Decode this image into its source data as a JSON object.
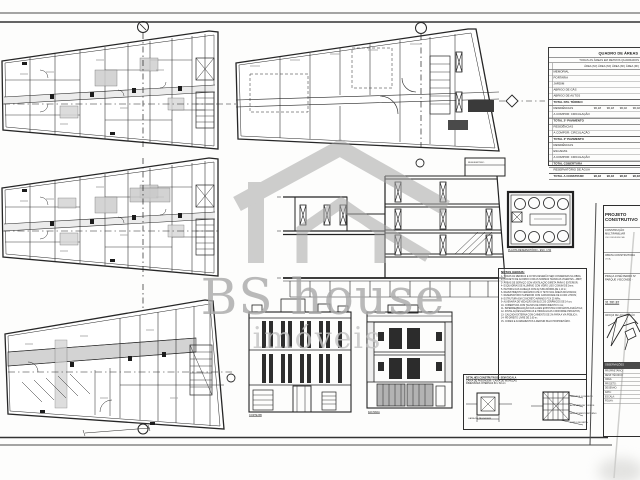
{
  "watermark": {
    "title": "BS house",
    "subtitle": "imóveis"
  },
  "area_table": {
    "title": "QUADRO DE ÁREAS",
    "subtitle": "TODAS AS ÁREAS EM METROS QUADRADOS",
    "col_header": "ÁREA (M²)    ÁREA (M²)    ÁREA (M²)    ÁREA (M²)",
    "rows": [
      {
        "label": "MEMORIAL",
        "vals": [
          "",
          "",
          "",
          ""
        ],
        "total": false
      },
      {
        "label": "PORTARIA",
        "vals": [
          "",
          "",
          "",
          ""
        ],
        "total": false
      },
      {
        "label": "JARDIM",
        "vals": [
          "",
          "",
          "",
          ""
        ],
        "total": false
      },
      {
        "label": "ABRIGO DE GÁS",
        "vals": [
          "",
          "",
          "",
          ""
        ],
        "total": false
      },
      {
        "label": "ABRIGO DE AUTOS",
        "vals": [
          "",
          "",
          "",
          ""
        ],
        "total": false
      },
      {
        "label": "TOTAL PAV. TÉRREO",
        "vals": [
          "",
          "",
          "",
          ""
        ],
        "total": true
      },
      {
        "label": "RESIDÊNCIAS",
        "vals": [
          "96,18",
          "96,18",
          "96,02",
          "96,02"
        ],
        "total": false
      },
      {
        "label": "A COMPOR: CIRCULAÇÃO",
        "vals": [
          "",
          "",
          "",
          ""
        ],
        "total": false
      },
      {
        "label": "TOTAL 2º PAVIMENTO",
        "vals": [
          "",
          "",
          "",
          ""
        ],
        "total": true
      },
      {
        "label": "RESIDÊNCIAS",
        "vals": [
          "",
          "",
          "",
          ""
        ],
        "total": false
      },
      {
        "label": "A COMPOR: CIRCULAÇÃO",
        "vals": [
          "",
          "",
          "",
          ""
        ],
        "total": false
      },
      {
        "label": "TOTAL 3º PAVIMENTO",
        "vals": [
          "",
          "",
          "",
          ""
        ],
        "total": true
      },
      {
        "label": "RESIDÊNCIAS",
        "vals": [
          "",
          "",
          "",
          ""
        ],
        "total": false
      },
      {
        "label": "ESCADAS",
        "vals": [
          "",
          "",
          "",
          ""
        ],
        "total": false
      },
      {
        "label": "A COMPOR: CIRCULAÇÃO",
        "vals": [
          "",
          "",
          "",
          ""
        ],
        "total": false
      },
      {
        "label": "TOTAL COBERTURA",
        "vals": [
          "",
          "",
          "",
          ""
        ],
        "total": true
      },
      {
        "label": "RESERVATÓRIO DE ÁGUA",
        "vals": [
          "",
          "",
          "",
          ""
        ],
        "total": false
      },
      {
        "label": "TOTAL A CONSTRUIR",
        "vals": [
          "96,18",
          "96,18",
          "96,02",
          "96,02"
        ],
        "total": true
      }
    ]
  },
  "notes": {
    "title": "NOTAS GERAIS:",
    "lines": [
      "1- TODAS AS MEDIDAS E COTAS DEVERÃO SER CONFERIDAS NA OBRA;",
      "2- PROJETO DE ACORDO COM AS NORMAS TÉCNICAS VIGENTES - ABNT;",
      "3- ÁREAS DE SERVIÇO COM VENTILAÇÃO DIRETA PARA O EXTERIOR;",
      "4- ESQUADRIAS DE ALUMÍNIO COM VIDRO LISO COMUM DE 3mm;",
      "5- PEITORIL DAS JANELAS COM ALTURA MÍNIMA DE 1,10 m;",
      "6- REVESTIMENTO CERÂMICO ATÉ O TETO NAS ÁREAS MOLHADAS;",
      "7- RESERVATÓRIO SUPERIOR COM CAPACIDADE DE 10.000 LITROS;",
      "8- ESTRUTURA EM CONCRETO ARMADO FCK 25 MPa;",
      "9- ALVENARIA DE VEDAÇÃO EM BLOCOS CERÂMICOS DE 14 cm;",
      "10- COBERTURA COM TELHAS DE FIBROCIMENTO 6 mm;",
      "11- IMPERMEABILIZAÇÃO DAS LAJES EXPOSTAS COM MANTA ASFÁLTICA;",
      "12- INSTALAÇÕES ELÉTRICAS E HIDRÁULICAS CONFORME PROJETOS;",
      "13- CALÇADA EXTERNA COM CAIMENTO DE 2% PARA A VIA PÚBLICA;",
      "14- PÉ-DIREITO LIVRE DE 2,60 m;",
      "15- CORES E ACABAMENTOS A DEFINIR PELO PROPRIETÁRIO."
    ]
  },
  "details": {
    "title": "DETALHES CONSTRUTIVOS - SEM ESCALA",
    "line2": "CAIXA DE PASSAGEM / CAIXA DE INSPEÇÃO",
    "line3": "DIMENSÕES INTERNAS 60 x 60 cm",
    "left_label": "CAIXA DE PASSAGEM",
    "right_labels": [
      "TAMPA DE CONCRETO",
      "ALVENARIA DE TIJOLOS",
      "REVESTIMENTO INTERNO",
      "FUNDO DE BRITA"
    ]
  },
  "drawing_labels": {
    "reservoir": "PLANTA RESERVATÓRIO - ESC. 1:50",
    "corte": "CORTE BB",
    "fachada": "FACHADA",
    "penthouse": "RESERVATÓRIO"
  },
  "title_block": {
    "header": "PROJETO CONSTRUTIVO",
    "use1": "CONSTRUÇÃO MULTIFAMILIAR",
    "use2": "USO RESIDENCIAL",
    "owner1": "OBATA CONSTRUTORA",
    "owner2": "LTDA.",
    "addr1": "PRAÇA JOSÉ PEDRO Nº",
    "addr2": "PARQUE VISCONDE -",
    "area_value": "31.281,82",
    "croqui_label": "CROQUI DE LOCALIZAÇÃO",
    "obs_header": "OBSERVAÇÕES",
    "rows": [
      "PROPRIETÁRIO:",
      "RESP. TÉCNICO:",
      "CREA:",
      "PROJETO:",
      "DESENHO:",
      "DATA:",
      "ESCALA:",
      "FOLHA:"
    ]
  }
}
